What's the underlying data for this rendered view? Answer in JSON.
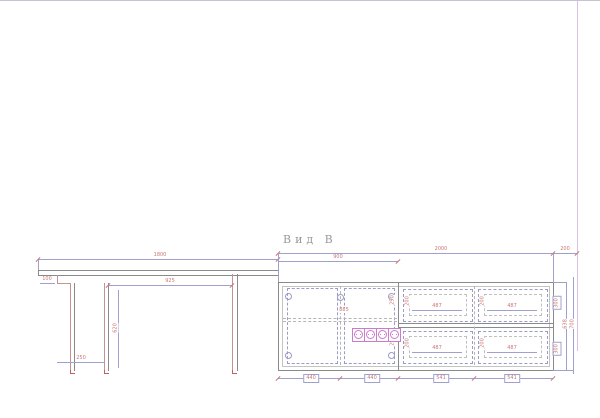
{
  "drawing": {
    "title": "Вид В",
    "desk": {
      "width": "1800",
      "overhang": "100",
      "knee_width": "925",
      "pedestal_depth": "250",
      "height": "620"
    },
    "cabinet": {
      "total_width": "2000",
      "wall_gap": "200",
      "door_section_width": "900",
      "door1_width": "440",
      "door2_width": "440",
      "drawer_col1_width": "541",
      "drawer_col2_width": "541",
      "drawer_front_width": "487",
      "drawer_front_height": "200",
      "divider_height_top": "290",
      "divider_height_bottom": "290",
      "shelf_width": "885",
      "side_label_top": "300",
      "side_label_bottom": "300",
      "height_inner": "638",
      "height_outer": "700"
    },
    "icons": {
      "socket_strip": "socket-strip-4"
    },
    "colors": {
      "wall": "#d6c2e6",
      "object_line": "#8a8a8a",
      "dimension_line": "#a0a0cc",
      "dimension_text": "#c87878",
      "socket": "#cc7acc",
      "title_text": "#9a9a9a"
    }
  }
}
